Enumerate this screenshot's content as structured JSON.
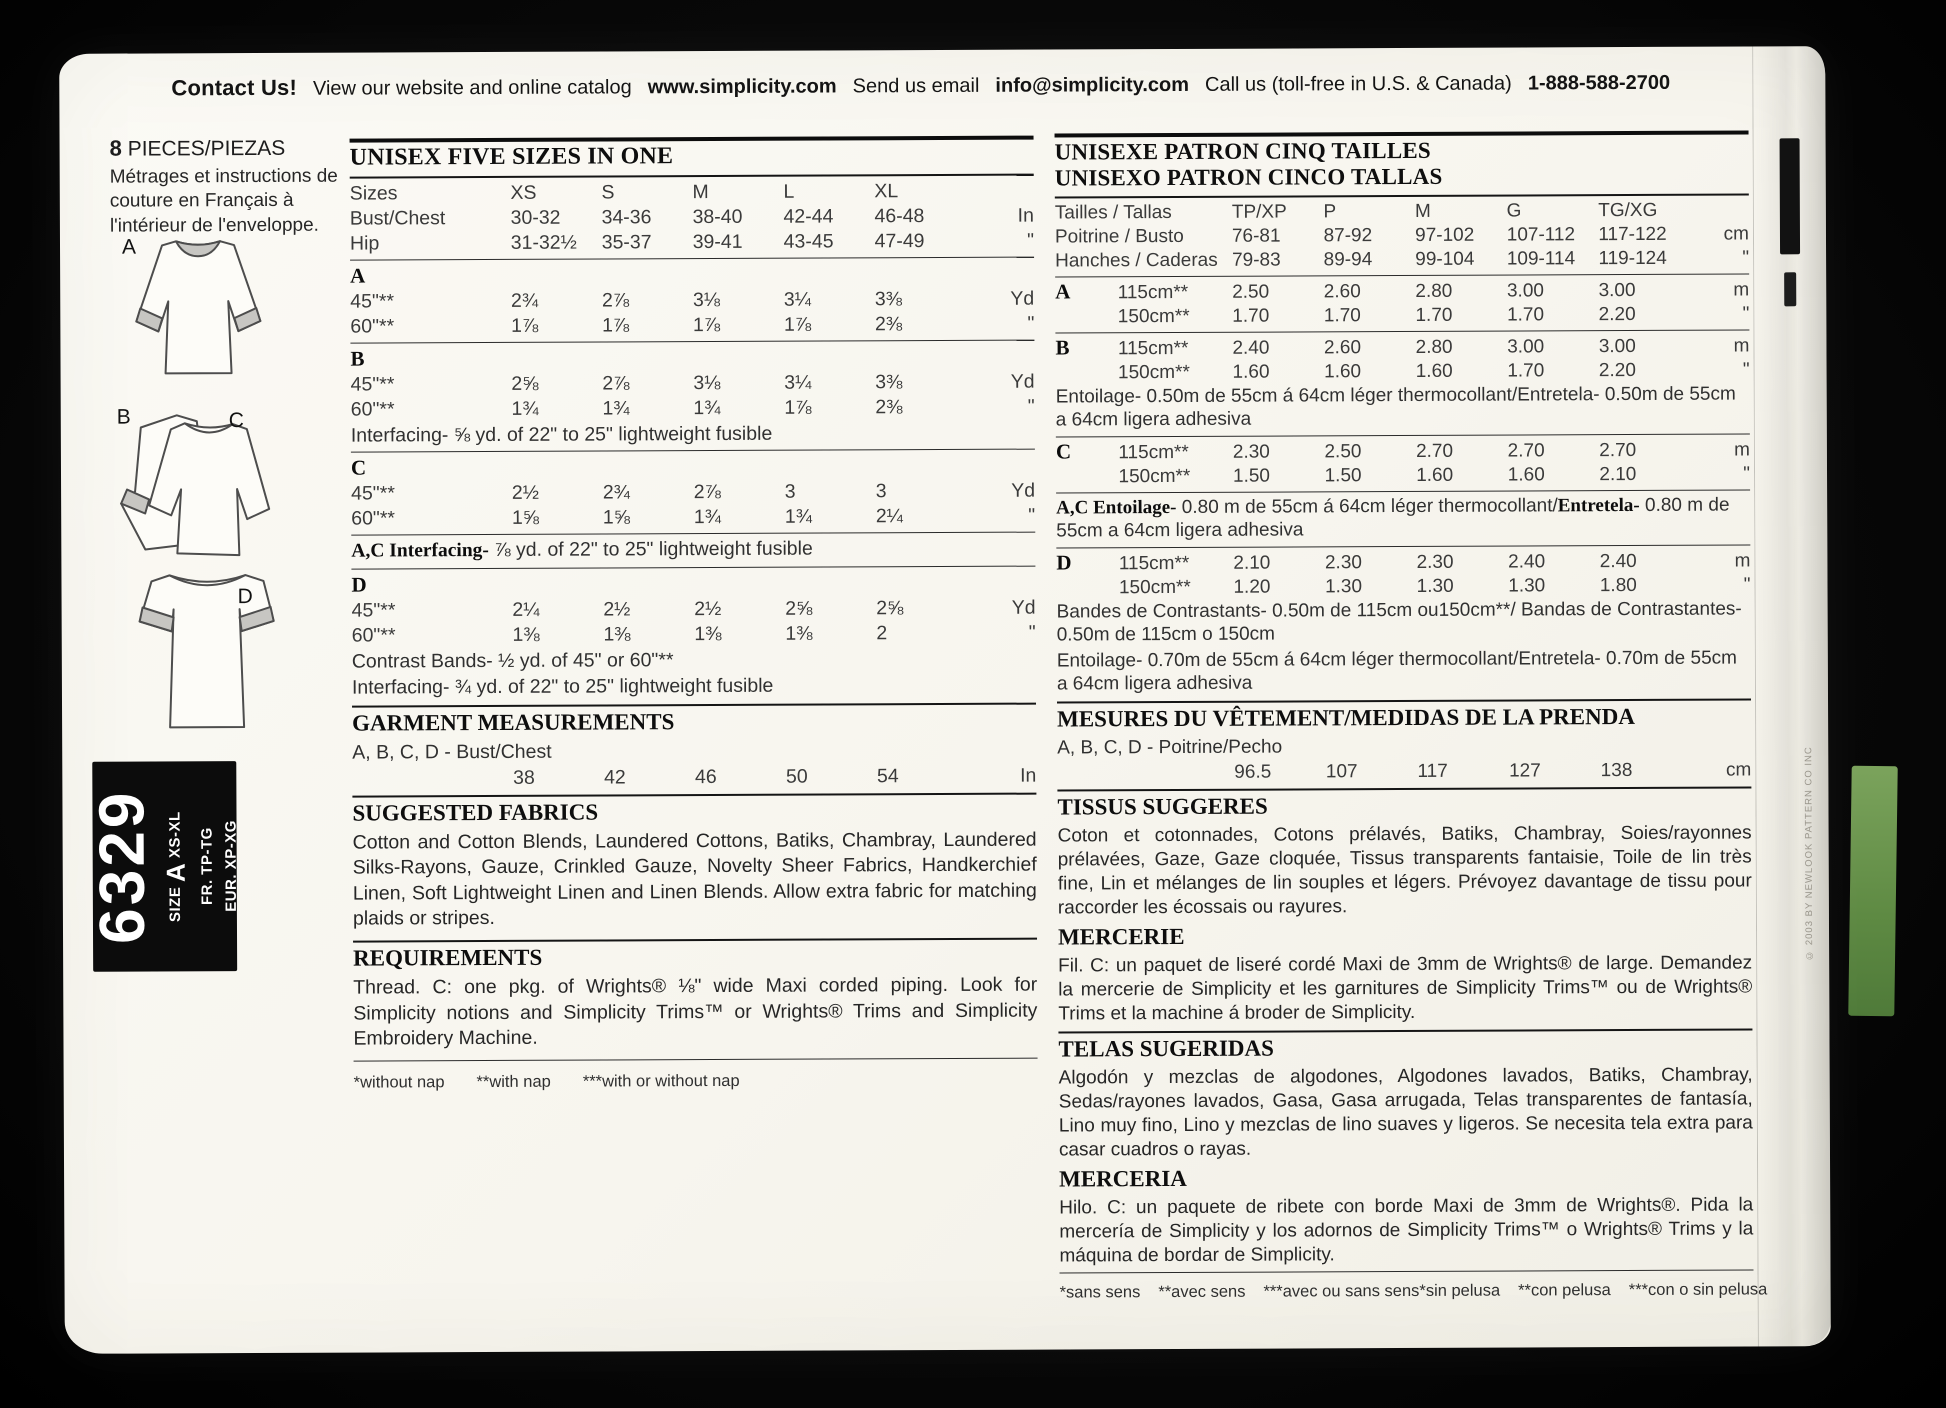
{
  "contact_bar": {
    "label": "Contact Us!",
    "website_text": "View our website and online catalog",
    "website_url": "www.simplicity.com",
    "email_text": "Send us email",
    "email": "info@simplicity.com",
    "phone_text": "Call us (toll-free in U.S. & Canada)",
    "phone": "1-888-588-2700"
  },
  "left_column": {
    "pieces_count": "8",
    "pieces_label": "PIECES/PIEZAS",
    "pieces_note": "Métrages et instructions de couture en Français à l'intérieur de l'enveloppe.",
    "views": {
      "a": "A",
      "b": "B",
      "c": "C",
      "d": "D"
    },
    "pattern_box": {
      "number": "6329",
      "size_prefix": "SIZE",
      "size_letter": "A",
      "size_range": "XS-XL",
      "fr_line": "FR. TP-TG",
      "eur_line": "EUR. XP-XG"
    }
  },
  "english_panel": {
    "title": "UNISEX FIVE SIZES IN ONE",
    "size_rows": [
      {
        "label": "Sizes",
        "values": [
          "XS",
          "S",
          "M",
          "L",
          "XL"
        ],
        "unit": ""
      },
      {
        "label": "Bust/Chest",
        "values": [
          "30-32",
          "34-36",
          "38-40",
          "42-44",
          "46-48"
        ],
        "unit": "In"
      },
      {
        "label": "Hip",
        "values": [
          "31-32½",
          "35-37",
          "39-41",
          "43-45",
          "47-49"
        ],
        "unit": "\""
      }
    ],
    "sections": [
      {
        "letter": "A",
        "rows": [
          {
            "label": "45\"**",
            "values": [
              "2¾",
              "2⅞",
              "3⅛",
              "3¼",
              "3⅜"
            ],
            "unit": "Yd"
          },
          {
            "label": "60\"**",
            "values": [
              "1⅞",
              "1⅞",
              "1⅞",
              "1⅞",
              "2⅜"
            ],
            "unit": "\""
          }
        ]
      },
      {
        "letter": "B",
        "rows": [
          {
            "label": "45\"**",
            "values": [
              "2⅝",
              "2⅞",
              "3⅛",
              "3¼",
              "3⅜"
            ],
            "unit": "Yd"
          },
          {
            "label": "60\"**",
            "values": [
              "1¾",
              "1¾",
              "1¾",
              "1⅞",
              "2⅜"
            ],
            "unit": "\""
          }
        ],
        "note": "Interfacing- ⅝ yd. of 22\" to 25\" lightweight fusible"
      },
      {
        "letter": "C",
        "rows": [
          {
            "label": "45\"**",
            "values": [
              "2½",
              "2¾",
              "2⅞",
              "3",
              "3"
            ],
            "unit": "Yd"
          },
          {
            "label": "60\"**",
            "values": [
              "1⅝",
              "1⅝",
              "1¾",
              "1¾",
              "2¼"
            ],
            "unit": "\""
          }
        ]
      },
      {
        "letter": "D",
        "rows": [
          {
            "label": "45\"**",
            "values": [
              "2¼",
              "2½",
              "2½",
              "2⅝",
              "2⅝"
            ],
            "unit": "Yd"
          },
          {
            "label": "60\"**",
            "values": [
              "1⅜",
              "1⅜",
              "1⅜",
              "1⅜",
              "2"
            ],
            "unit": "\""
          }
        ],
        "note": "Contrast Bands- ½ yd. of 45\" or 60\"**",
        "note2": "Interfacing- ¾ yd. of 22\" to 25\" lightweight fusible"
      }
    ],
    "ac_interfacing": {
      "bold": "A,C Interfacing-",
      "text": " ⅞ yd. of 22\" to 25\" lightweight fusible"
    },
    "garment_measurements": {
      "title": "GARMENT MEASUREMENTS",
      "label": "A, B, C, D - Bust/Chest",
      "row": {
        "label": "",
        "values": [
          "38",
          "42",
          "46",
          "50",
          "54"
        ],
        "unit": "In"
      }
    },
    "suggested_fabrics": {
      "title": "SUGGESTED FABRICS",
      "text": "Cotton and Cotton Blends, Laundered Cottons, Batiks, Chambray, Laundered Silks-Rayons, Gauze, Crinkled Gauze, Novelty Sheer Fabrics, Handkerchief Linen, Soft Lightweight Linen and Linen Blends. Allow extra fabric for matching plaids or stripes."
    },
    "requirements": {
      "title": "REQUIREMENTS",
      "text": "Thread. C: one pkg. of Wrights® ⅛\" wide Maxi corded piping. Look for Simplicity notions and Simplicity Trims™ or Wrights® Trims and Simplicity Embroidery Machine."
    },
    "footnotes": [
      "*without nap",
      "**with nap",
      "***with or without nap"
    ]
  },
  "french_panel": {
    "title_fr": "UNISEXE PATRON CINQ TAILLES",
    "title_es": "UNISEXO PATRON CINCO TALLAS",
    "size_rows": [
      {
        "label": "Tailles / Tallas",
        "values": [
          "TP/XP",
          "P",
          "M",
          "G",
          "TG/XG"
        ],
        "unit": ""
      },
      {
        "label": "Poitrine / Busto",
        "values": [
          "76-81",
          "87-92",
          "97-102",
          "107-112",
          "117-122"
        ],
        "unit": "cm"
      },
      {
        "label": "Hanches / Caderas",
        "values": [
          "79-83",
          "89-94",
          "99-104",
          "109-114",
          "119-124"
        ],
        "unit": "\""
      }
    ],
    "sections": [
      {
        "rows": [
          {
            "letter": "A",
            "label": "115cm**",
            "values": [
              "2.50",
              "2.60",
              "2.80",
              "3.00",
              "3.00"
            ],
            "unit": "m"
          },
          {
            "letter": "",
            "label": "150cm**",
            "values": [
              "1.70",
              "1.70",
              "1.70",
              "1.70",
              "2.20"
            ],
            "unit": "\""
          }
        ]
      },
      {
        "rows": [
          {
            "letter": "B",
            "label": "115cm**",
            "values": [
              "2.40",
              "2.60",
              "2.80",
              "3.00",
              "3.00"
            ],
            "unit": "m"
          },
          {
            "letter": "",
            "label": "150cm**",
            "values": [
              "1.60",
              "1.60",
              "1.60",
              "1.70",
              "2.20"
            ],
            "unit": "\""
          }
        ],
        "note": "Entoilage- 0.50m de 55cm á 64cm léger thermocollant/Entretela- 0.50m de 55cm a 64cm ligera adhesiva"
      },
      {
        "rows": [
          {
            "letter": "C",
            "label": "115cm**",
            "values": [
              "2.30",
              "2.50",
              "2.70",
              "2.70",
              "2.70"
            ],
            "unit": "m"
          },
          {
            "letter": "",
            "label": "150cm**",
            "values": [
              "1.50",
              "1.50",
              "1.60",
              "1.60",
              "2.10"
            ],
            "unit": "\""
          }
        ]
      },
      {
        "rows": [
          {
            "letter": "D",
            "label": "115cm**",
            "values": [
              "2.10",
              "2.30",
              "2.30",
              "2.40",
              "2.40"
            ],
            "unit": "m"
          },
          {
            "letter": "",
            "label": "150cm**",
            "values": [
              "1.20",
              "1.30",
              "1.30",
              "1.30",
              "1.80"
            ],
            "unit": "\""
          }
        ],
        "note": "Bandes de Contrastants- 0.50m de 115cm ou150cm**/ Bandas de Contrastantes- 0.50m de 115cm o 150cm",
        "note2": "Entoilage- 0.70m de 55cm á 64cm léger thermocollant/Entretela- 0.70m de 55cm a 64cm ligera adhesiva"
      }
    ],
    "ac_entoilage": {
      "bold1": "A,C Entoilage-",
      "text1": " 0.80 m de 55cm á 64cm léger thermocollant/",
      "bold2": "Entretela-",
      "text2": " 0.80 m de 55cm a 64cm ligera adhesiva"
    },
    "mesures": {
      "title": "MESURES DU VÊTEMENT/MEDIDAS DE LA PRENDA",
      "label": "A, B, C, D - Poitrine/Pecho",
      "row": {
        "label": "",
        "values": [
          "96.5",
          "107",
          "117",
          "127",
          "138"
        ],
        "unit": "cm"
      }
    },
    "tissus": {
      "title": "TISSUS SUGGERES",
      "text": "Coton et cotonnades, Cotons prélavés, Batiks, Chambray, Soies/rayonnes prélavées, Gaze, Gaze cloquée, Tissus transparents fantaisie, Toile de lin très fine, Lin et mélanges de lin souples et légers. Prévoyez davantage de tissu pour raccorder les écossais ou rayures."
    },
    "mercerie": {
      "title": "MERCERIE",
      "text": "Fil. C: un paquet de liseré cordé Maxi de 3mm de Wrights® de large. Demandez la mercerie de Simplicity et les garnitures de Simplicity Trims™ ou de Wrights® Trims et la machine á broder de Simplicity."
    },
    "telas": {
      "title": "TELAS SUGERIDAS",
      "text": "Algodón y mezclas de algodones, Algodones lavados, Batiks, Chambray, Sedas/rayones lavados, Gasa, Gasa arrugada, Telas transparentes de fantasía, Lino muy fino, Lino y mezclas de lino suaves y ligeros. Se necesita tela extra para casar cuadros o rayas."
    },
    "merceria": {
      "title": "MERCERIA",
      "text": "Hilo. C: un paquete de ribete con borde Maxi de 3mm de Wrights®. Pida la mercería de Simplicity y los adornos de Simplicity Trims™ o Wrights® Trims y la máquina de bordar de Simplicity."
    },
    "footnotes_fr": [
      "*sans sens",
      "**avec sens",
      "***avec ou sans sens"
    ],
    "footnotes_es": [
      "*sin pelusa",
      "**con pelusa",
      "***con o sin pelusa"
    ]
  },
  "edge": {
    "copyright": "© 2003 BY NEWLOOK PATTERN CO INC"
  },
  "colors": {
    "paper": "#f8f6f0",
    "ink": "#1a1a1a",
    "box": "#0c0c0c",
    "green_strip": "#6d9b52"
  }
}
